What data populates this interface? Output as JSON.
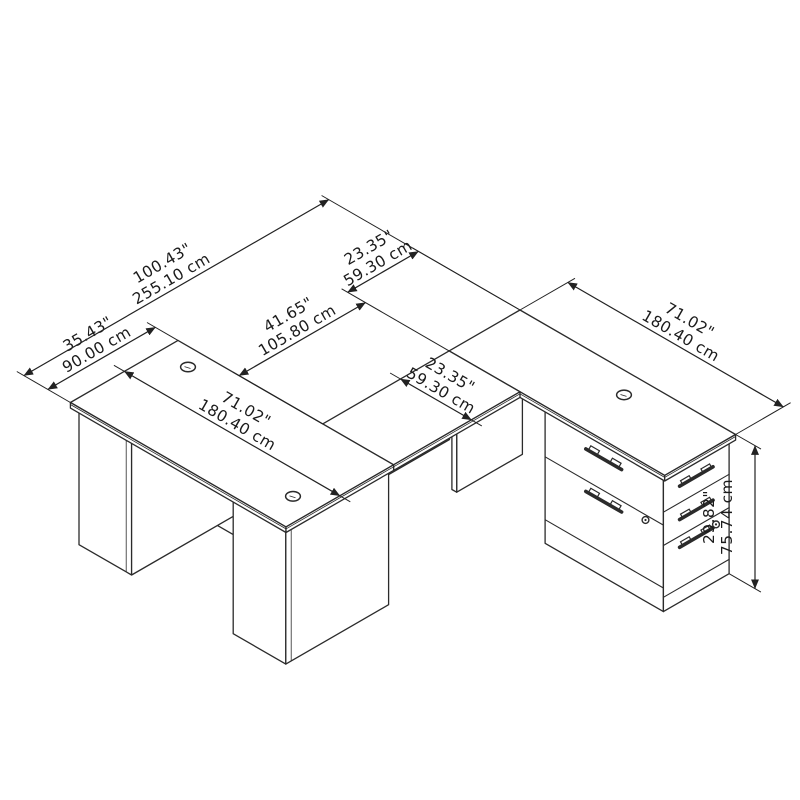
{
  "figure": {
    "subject": "U-shaped desk with drawer pedestal - isometric dimension drawing",
    "background_color": "#ffffff",
    "line_color": "#2b2b2b",
    "dimensions": {
      "overall_depth": {
        "inches": "100.43\"",
        "cm": "255.10 cm"
      },
      "knee_clearance": {
        "inches": "41.65\"",
        "cm": "105.80 cm"
      },
      "credenza_depth": {
        "inches": "23.35\"",
        "cm": "59.30 cm"
      },
      "bridge_width": {
        "inches": "23.35\"",
        "cm": "59.30 cm"
      },
      "desk_depth": {
        "inches": "35.43\"",
        "cm": "90.00 cm"
      },
      "credenza_length": {
        "inches": "71.02\"",
        "cm": "180.40 cm"
      },
      "desk_length": {
        "inches": "71.02\"",
        "cm": "180.40 cm"
      },
      "height": {
        "inches": "29.82\"",
        "cm": "75.74 cm"
      }
    }
  }
}
